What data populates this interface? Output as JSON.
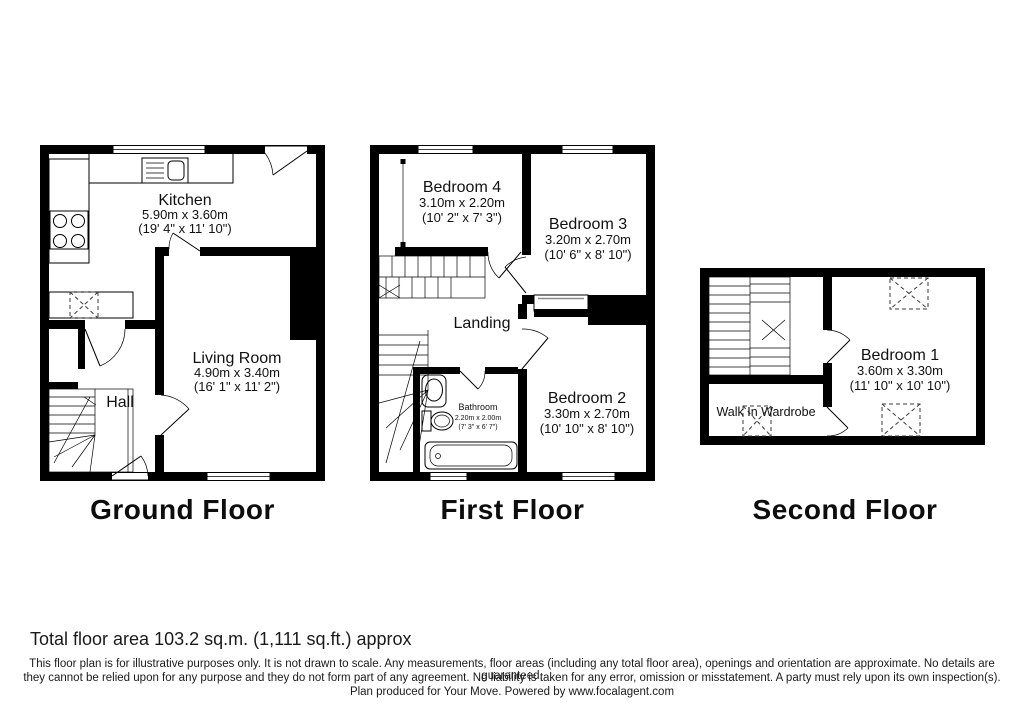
{
  "floors": [
    {
      "caption": "Ground Floor",
      "rooms": [
        {
          "name": "Kitchen",
          "metric": "5.90m x 3.60m",
          "imperial": "(19' 4\" x 11' 10\")"
        },
        {
          "name": "Living Room",
          "metric": "4.90m x 3.40m",
          "imperial": "(16' 1\" x 11' 2\")"
        },
        {
          "name": "Hall"
        }
      ]
    },
    {
      "caption": "First Floor",
      "rooms": [
        {
          "name": "Bedroom 4",
          "metric": "3.10m x 2.20m",
          "imperial": "(10' 2\" x 7' 3\")"
        },
        {
          "name": "Bedroom 3",
          "metric": "3.20m x 2.70m",
          "imperial": "(10' 6\" x 8' 10\")"
        },
        {
          "name": "Landing"
        },
        {
          "name": "Bathroom",
          "metric": "2.20m x 2.00m",
          "imperial": "(7' 3\" x 6' 7\")"
        },
        {
          "name": "Bedroom 2",
          "metric": "3.30m x 2.70m",
          "imperial": "(10' 10\" x 8' 10\")"
        }
      ]
    },
    {
      "caption": "Second Floor",
      "rooms": [
        {
          "name": "Bedroom 1",
          "metric": "3.60m x 3.30m",
          "imperial": "(11' 10\" x 10' 10\")"
        },
        {
          "name": "Walk In Wardrobe"
        }
      ]
    }
  ],
  "footer": {
    "total_area": "Total floor area 103.2 sq.m. (1,111 sq.ft.) approx",
    "disclaimer_lines": [
      "This floor plan is for illustrative purposes only. It is not drawn to scale. Any measurements, floor areas (including any total floor area), openings and orientation are approximate. No details are guaranteed,",
      "they cannot be relied upon for any purpose and they do not form part of any agreement. No liability is taken for any error, omission or misstatement. A party must rely upon its own inspection(s).",
      "Plan produced for Your Move. Powered by www.focalagent.com"
    ]
  },
  "colors": {
    "wall": "#000000",
    "background": "#ffffff"
  }
}
